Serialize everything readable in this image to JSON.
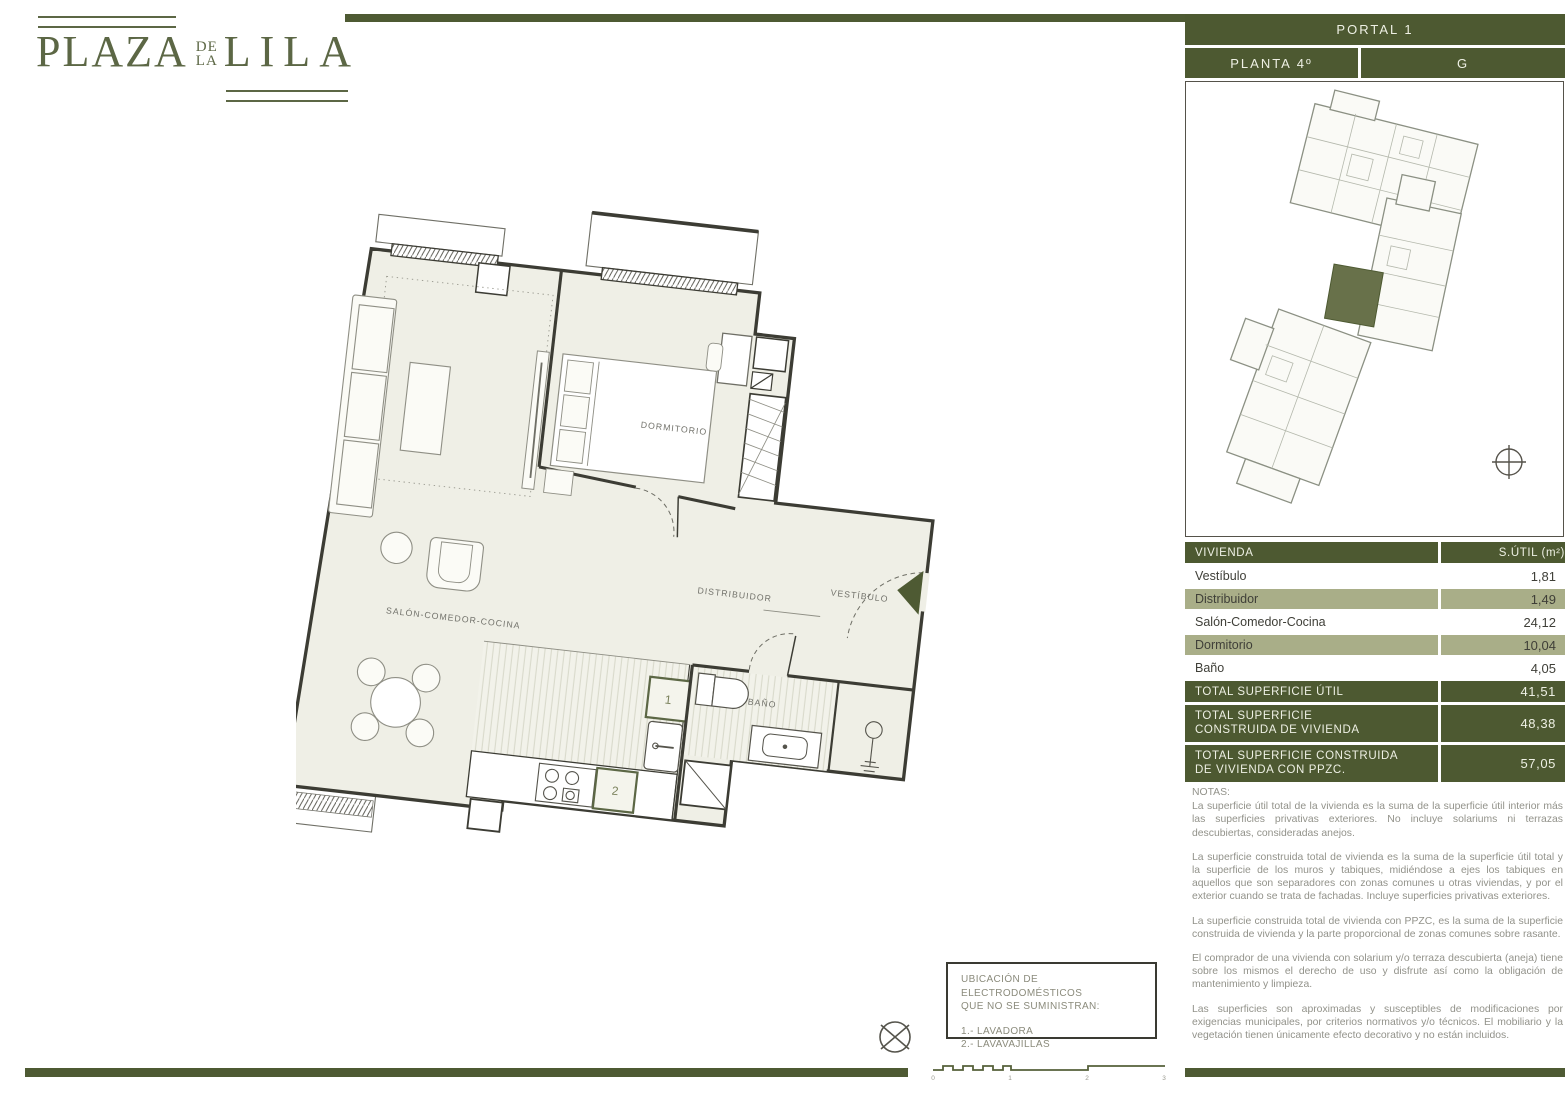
{
  "brand": {
    "plaza": "PLAZA",
    "de": "DE",
    "la": "LA",
    "lila": "LILA"
  },
  "header": {
    "portal": "PORTAL 1",
    "planta": "PLANTA 4º",
    "letter": "G"
  },
  "table": {
    "header": {
      "col1": "VIVIENDA",
      "col2": "S.ÚTIL (m²)"
    },
    "rows": [
      {
        "label": "Vestíbulo",
        "value": "1,81",
        "shade": "white"
      },
      {
        "label": "Distribuidor",
        "value": "1,49",
        "shade": "sage"
      },
      {
        "label": "Salón-Comedor-Cocina",
        "value": "24,12",
        "shade": "white"
      },
      {
        "label": "Dormitorio",
        "value": "10,04",
        "shade": "sage"
      },
      {
        "label": "Baño",
        "value": "4,05",
        "shade": "white"
      }
    ],
    "totals": [
      {
        "line1": "TOTAL SUPERFICIE ÚTIL",
        "line2": "",
        "value": "41,51"
      },
      {
        "line1": "TOTAL SUPERFICIE",
        "line2": "CONSTRUIDA DE VIVIENDA",
        "value": "48,38"
      },
      {
        "line1": "TOTAL SUPERFICIE CONSTRUIDA",
        "line2": "DE VIVIENDA CON PPZC.",
        "value": "57,05"
      }
    ]
  },
  "notes": {
    "title": "NOTAS:",
    "paragraphs": [
      "La superficie útil total de la vivienda es la suma de la superficie útil interior más las superficies privativas exteriores. No incluye solariums ni terrazas descubiertas, consideradas anejos.",
      "La superficie construida total de vivienda es la suma de la superficie útil total y la superficie de los muros y tabiques, midiéndose a ejes los tabiques en aquellos que son separadores con zonas comunes u otras viviendas, y por el exterior cuando se trata de fachadas. Incluye superficies privativas exteriores.",
      "La superficie construida total de vivienda con PPZC, es la suma de la superficie construida de vivienda y la parte proporcional de zonas comunes sobre rasante.",
      "El comprador de una vivienda con solarium y/o terraza descubierta (aneja) tiene sobre los mismos el derecho de uso y disfrute así como la obligación de mantenimiento y limpieza.",
      "Las superficies son aproximadas y susceptibles de modificaciones por exigencias municipales, por criterios normativos y/o técnicos. El mobiliario y la vegetación tienen únicamente efecto decorativo y no están incluidos."
    ]
  },
  "appliances": {
    "title_line1": "UBICACIÓN DE ELECTRODOMÉSTICOS",
    "title_line2": "QUE NO SE SUMINISTRAN:",
    "items": [
      "1.- LAVADORA",
      "2.- LAVAVAJILLAS"
    ]
  },
  "plan": {
    "labels": {
      "dormitorio": "DORMITORIO",
      "distribuidor": "DISTRIBUIDOR",
      "vestibulo": "VESTÍBULO",
      "salon": "SALÓN-COMEDOR-COCINA",
      "bano": "BAÑO"
    },
    "markers": {
      "m1": "1",
      "m2": "2"
    }
  },
  "scalebar": {
    "ticks": [
      "0",
      "1",
      "2",
      "3"
    ]
  },
  "colors": {
    "dark_olive": "#4d5931",
    "sage": "#a9ae88",
    "plan_fill": "#efefe6",
    "brand_green": "#5c6745"
  }
}
